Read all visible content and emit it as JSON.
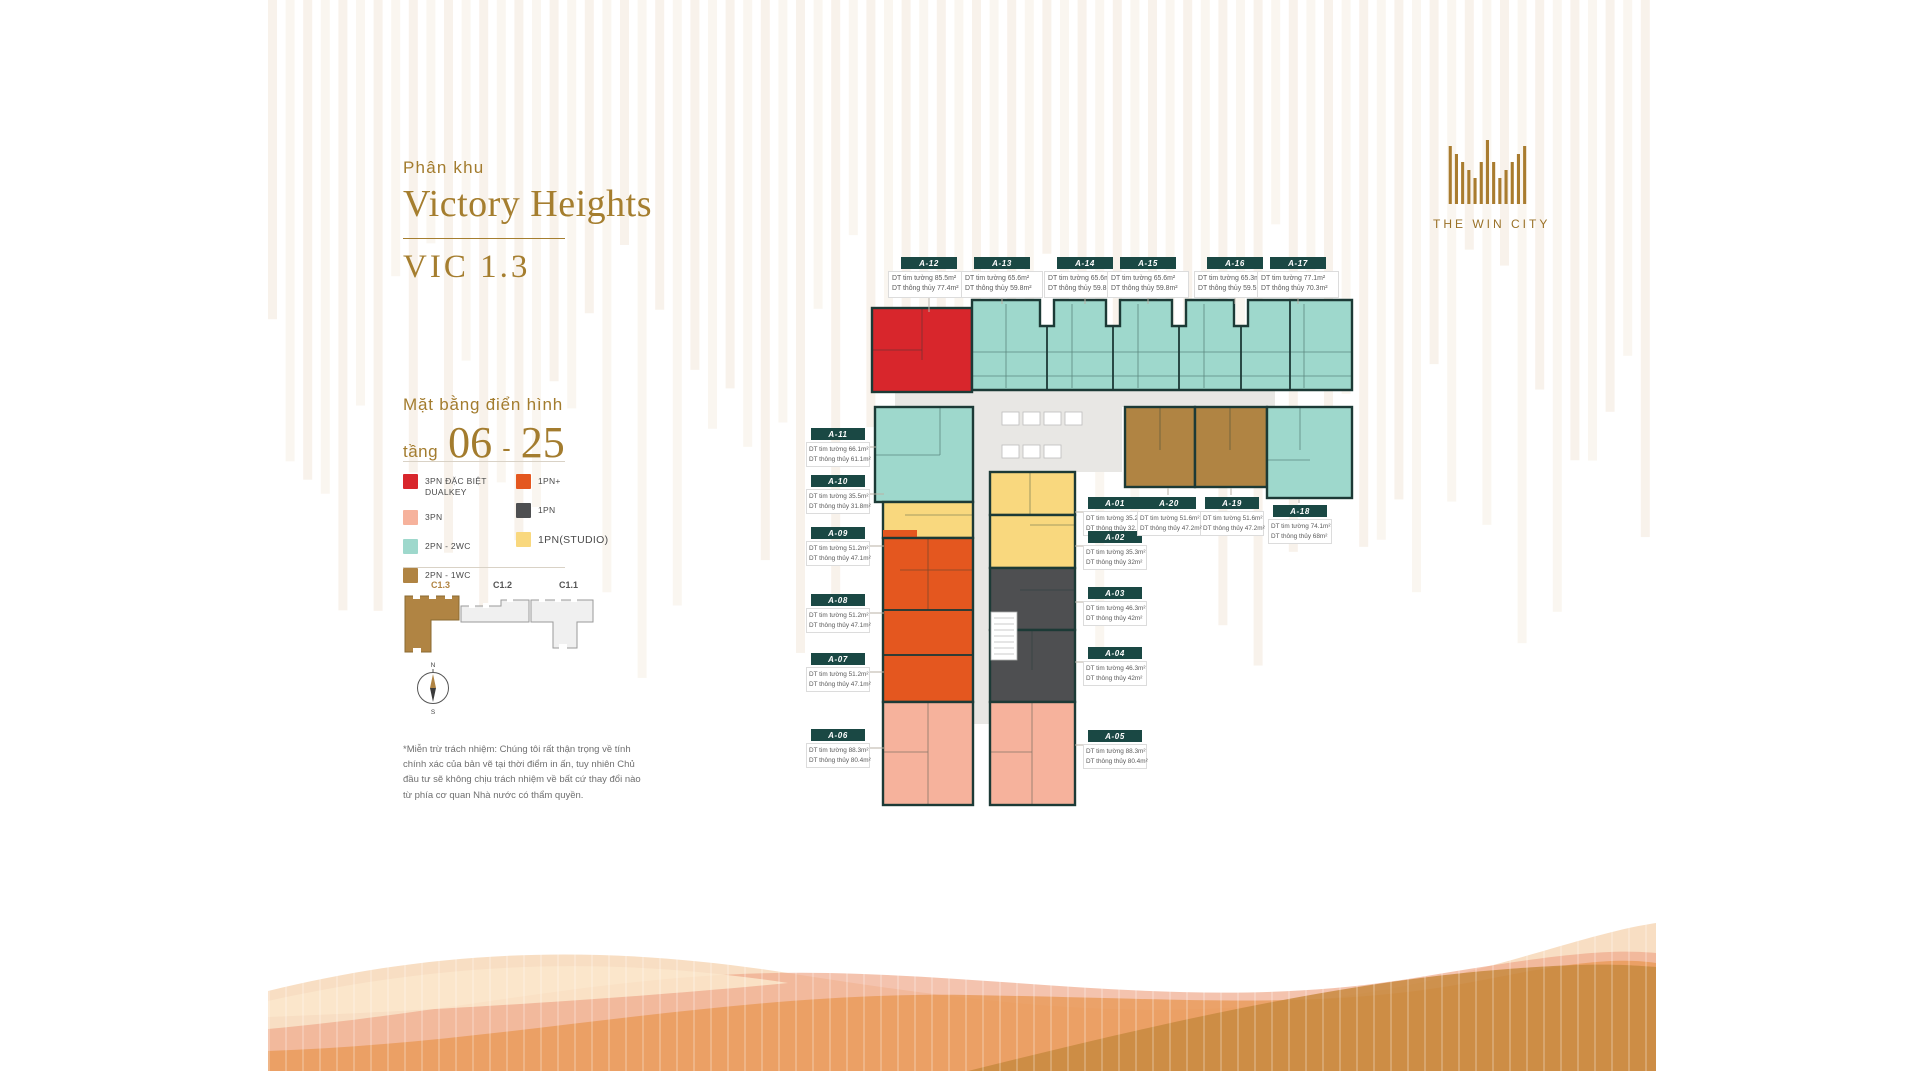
{
  "header": {
    "subtitle": "Phân khu",
    "title": "Victory Heights",
    "code": "VIC 1.3"
  },
  "floor_info": {
    "line1": "Mặt bằng điển hình",
    "prefix": "tầng",
    "from": "06",
    "dash": "-",
    "to": "25"
  },
  "legend": {
    "items": [
      {
        "label": "3PN ĐẶC BIỆT DUALKEY",
        "color": "#D8262C",
        "key": "red"
      },
      {
        "label": "3PN",
        "color": "#F6B29C",
        "key": "salmon"
      },
      {
        "label": "2PN - 2WC",
        "color": "#9ED8CC",
        "key": "teal"
      },
      {
        "label": "2PN - 1WC",
        "color": "#B08443",
        "key": "brown"
      },
      {
        "label": "1PN+",
        "color": "#E4571F",
        "key": "orange"
      },
      {
        "label": "1PN",
        "color": "#4E4F51",
        "key": "dark"
      },
      {
        "label": "1PN(STUDIO)",
        "color": "#F9D87E",
        "key": "yellow"
      }
    ]
  },
  "keyplan": {
    "buildings": [
      "C1.3",
      "C1.2",
      "C1.1"
    ],
    "highlight": "C1.3"
  },
  "compass": {
    "north": "N",
    "south": "S"
  },
  "disclaimer": "*Miễn trừ trách nhiệm: Chúng tôi rất thận trọng về tính chính xác của bản vẽ tại thời điểm in ấn, tuy nhiên Chủ đầu tư sẽ không chịu trách nhiệm về bất cứ thay đổi nào từ phía cơ quan Nhà nước có thẩm quyền.",
  "logo": {
    "name": "THE WIN CITY"
  },
  "plan": {
    "area_label_prefixes": {
      "gross": "DT tim tường",
      "net": "DT thông thủy"
    },
    "units": [
      {
        "id": "A-01",
        "type": "1PN(STUDIO)",
        "gross": "35.2m²",
        "net": "32.1m²"
      },
      {
        "id": "A-02",
        "type": "1PN(STUDIO)",
        "gross": "35.3m²",
        "net": "32m²"
      },
      {
        "id": "A-03",
        "type": "1PN",
        "gross": "46.3m²",
        "net": "42m²"
      },
      {
        "id": "A-04",
        "type": "1PN",
        "gross": "46.3m²",
        "net": "42m²"
      },
      {
        "id": "A-05",
        "type": "3PN",
        "gross": "88.3m²",
        "net": "80.4m²"
      },
      {
        "id": "A-06",
        "type": "3PN",
        "gross": "88.3m²",
        "net": "80.4m²"
      },
      {
        "id": "A-07",
        "type": "1PN+",
        "gross": "51.2m²",
        "net": "47.1m²"
      },
      {
        "id": "A-08",
        "type": "1PN+",
        "gross": "51.2m²",
        "net": "47.1m²"
      },
      {
        "id": "A-09",
        "type": "1PN+",
        "gross": "51.2m²",
        "net": "47.1m²"
      },
      {
        "id": "A-10",
        "type": "1PN(STUDIO)",
        "gross": "35.5m²",
        "net": "31.8m²"
      },
      {
        "id": "A-11",
        "type": "2PN - 2WC",
        "gross": "66.1m²",
        "net": "61.1m²"
      },
      {
        "id": "A-12",
        "type": "3PN ĐẶC BIỆT DUALKEY",
        "gross": "85.5m²",
        "net": "77.4m²"
      },
      {
        "id": "A-13",
        "type": "2PN - 2WC",
        "gross": "65.6m²",
        "net": "59.8m²"
      },
      {
        "id": "A-14",
        "type": "2PN - 2WC",
        "gross": "65.6m²",
        "net": "59.8m²"
      },
      {
        "id": "A-15",
        "type": "2PN - 2WC",
        "gross": "65.6m²",
        "net": "59.8m²"
      },
      {
        "id": "A-16",
        "type": "2PN - 2WC",
        "gross": "65.3m²",
        "net": "59.5m²"
      },
      {
        "id": "A-17",
        "type": "2PN - 2WC",
        "gross": "77.1m²",
        "net": "70.3m²"
      },
      {
        "id": "A-18",
        "type": "2PN - 2WC",
        "gross": "74.1m²",
        "net": "68m²"
      },
      {
        "id": "A-19",
        "type": "2PN - 1WC",
        "gross": "51.6m²",
        "net": "47.2m²"
      },
      {
        "id": "A-20",
        "type": "2PN - 1WC",
        "gross": "51.6m²",
        "net": "47.2m²"
      }
    ]
  }
}
